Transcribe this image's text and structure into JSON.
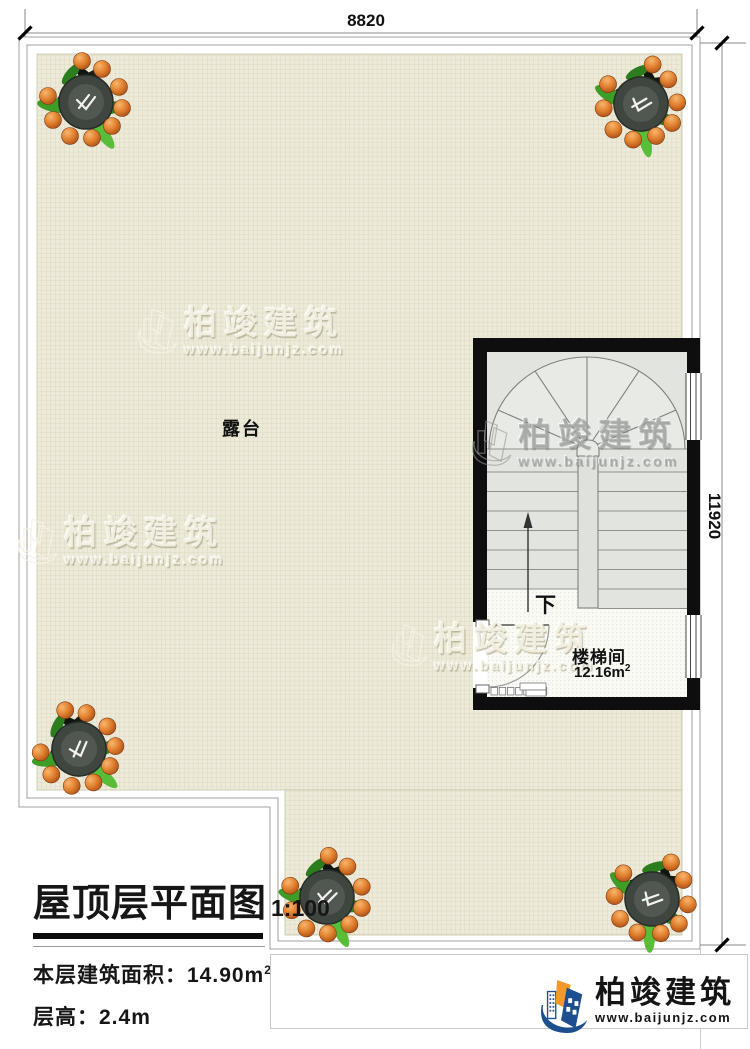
{
  "dimensions": {
    "width_label": "8820",
    "height_label": "11920"
  },
  "plan": {
    "terrace_label": "露台",
    "stair_room_label": "楼梯间",
    "stair_area_value": "12.16m",
    "stair_area_sup": "2",
    "down_label": "下"
  },
  "title_block": {
    "title": "屋顶层平面图",
    "scale": "1:100",
    "area_label": "本层建筑面积：",
    "area_value": "14.90m",
    "area_sup": "2",
    "floor_height": "层高：2.4m"
  },
  "brand": {
    "name": "柏竣建筑",
    "url": "www.baijunjz.com"
  },
  "colors": {
    "wall": "#0e0e0e",
    "grid_bg": "#edead9",
    "grid_line": "#d8d4ba",
    "stair_floor": "#e2e5df",
    "accent_orange": "#f09a2c",
    "accent_blue": "#1d4f8f"
  }
}
